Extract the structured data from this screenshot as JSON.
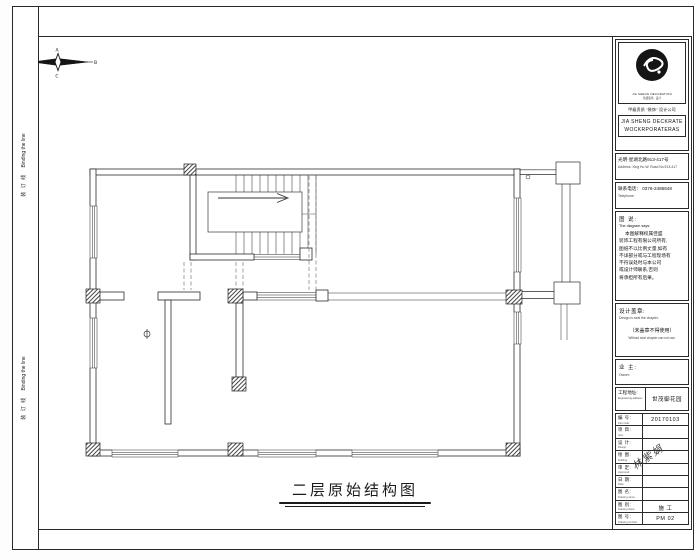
{
  "sheet": {
    "title": "二层原始结构图"
  },
  "binding": {
    "zh": "装 订 线",
    "en": "Binding the line"
  },
  "compass": {
    "top": "A",
    "right": "B",
    "bottom": "C",
    "left": "D"
  },
  "company": {
    "logo_caption": "JIA SHENG DECORATION",
    "logo_sub": "佳盛装饰 · 设计",
    "qualification": "甲级资质 “装饰” 设计公司",
    "name_line1": "JIA SHENG DECKRATE",
    "name_line2": "WOCKRPORATERAS",
    "address_zh": "光明·星湖北路913-417号",
    "address_en": "Address: Xing Hu W. Road No.913-417",
    "phone_zh": "联系电话： 0376-2486648",
    "phone_en": "Telephone:"
  },
  "notes": {
    "heading_zh": "图 说:",
    "heading_en": "The diagram says:",
    "lines": [
      "本图解释权属佳盛",
      "装饰工程有限公司所有,",
      "图纸不以比例丈量,如有",
      "不详部分或与工程现场有",
      "不符误处时与本公司",
      "或设计师联系,否则",
      "将承担所有后果。"
    ]
  },
  "stamp": {
    "label_zh": "设计盖章:",
    "label_en": "Design is seal the chapter.",
    "warn_zh": "（未盖章不得使用）",
    "warn_en": "Without seal chapter can not use."
  },
  "owner": {
    "label_zh": "业 主:",
    "label_en": "Owner:"
  },
  "project": {
    "label_zh": "工程地址:",
    "label_en": "Engineering address:",
    "value": "世茂御花园"
  },
  "table": {
    "rows": [
      {
        "zh": "编 号:",
        "en": "Part code:",
        "value": "20170103"
      },
      {
        "zh": "项 目:",
        "en": "Item:",
        "value": ""
      },
      {
        "zh": "设 计:",
        "en": "Design:",
        "value": ""
      },
      {
        "zh": "绘 图:",
        "en": "Drafting:",
        "value": ""
      },
      {
        "zh": "审 定:",
        "en": "Approved:",
        "value": ""
      },
      {
        "zh": "日 期:",
        "en": "Date:",
        "value": ""
      },
      {
        "zh": "图 名:",
        "en": "Drawing name:",
        "value": ""
      },
      {
        "zh": "图 别:",
        "en": "Drawing class:",
        "value": "施 工"
      },
      {
        "zh": "图 号:",
        "en": "Drawing number:",
        "value": "PM 02"
      }
    ]
  },
  "signature": "林紫娟"
}
